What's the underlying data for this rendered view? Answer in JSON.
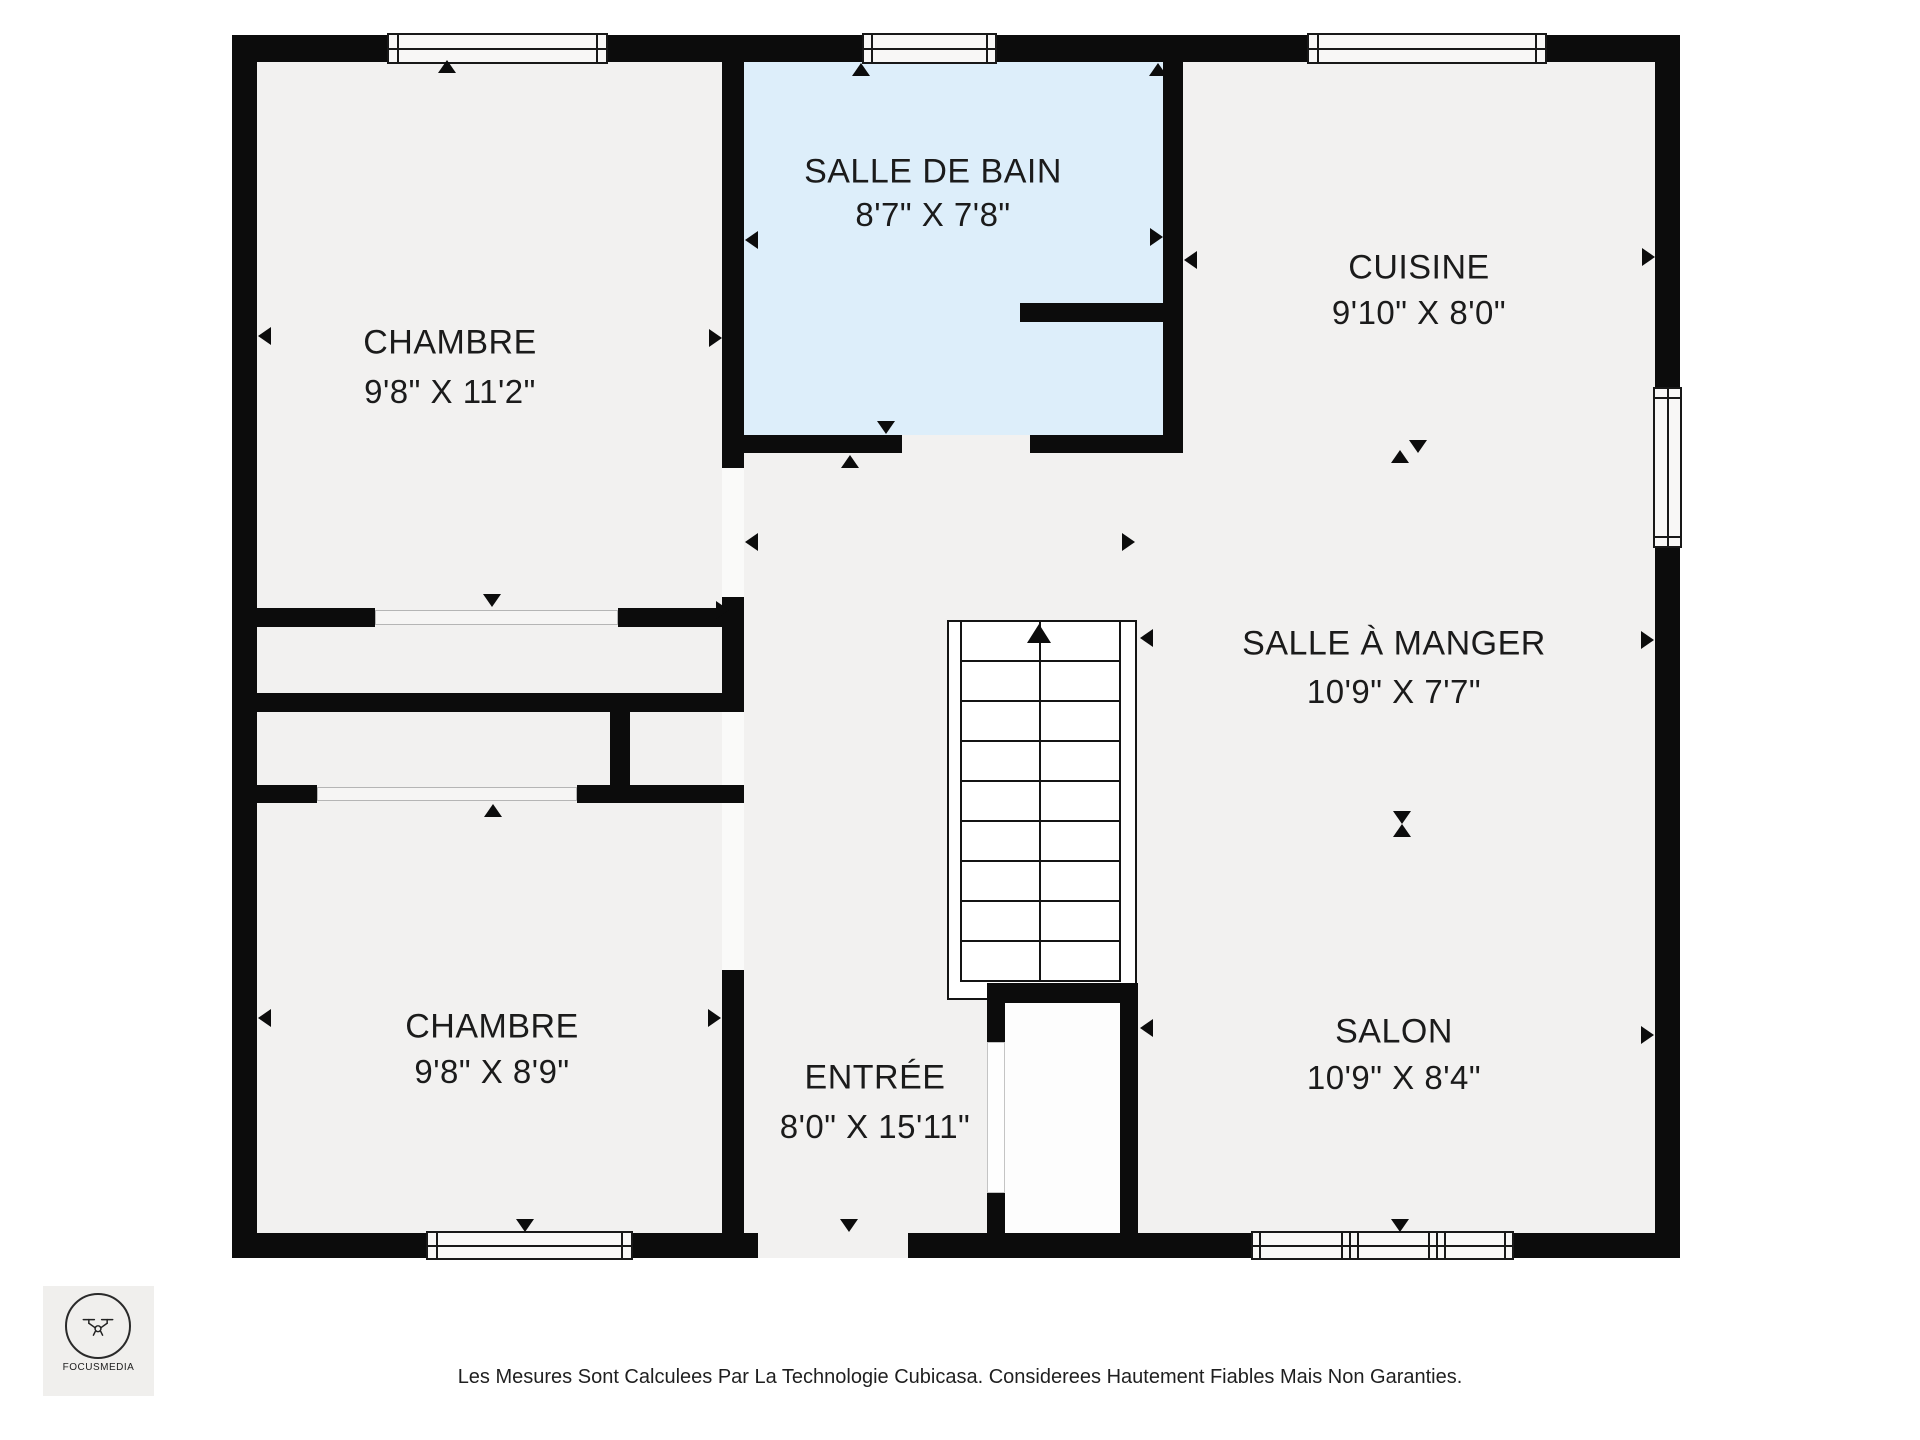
{
  "rooms": [
    {
      "id": "chambre-1",
      "name": "CHAMBRE",
      "dims": "9'8\" X 11'2\""
    },
    {
      "id": "salle-de-bain",
      "name": "SALLE DE BAIN",
      "dims": "8'7\" X 7'8\""
    },
    {
      "id": "cuisine",
      "name": "CUISINE",
      "dims": "9'10\" X 8'0\""
    },
    {
      "id": "salle-a-manger",
      "name": "SALLE À MANGER",
      "dims": "10'9\" X 7'7\""
    },
    {
      "id": "salon",
      "name": "SALON",
      "dims": "10'9\" X 8'4\""
    },
    {
      "id": "entree",
      "name": "ENTRÉE",
      "dims": "8'0\" X 15'11\""
    },
    {
      "id": "chambre-2",
      "name": "CHAMBRE",
      "dims": "9'8\" X 8'9\""
    }
  ],
  "logo": {
    "name": "FOCUSMEDIA"
  },
  "footer": {
    "disclaimer": "Les Mesures Sont Calculees Par La Technologie Cubicasa. Considerees Hautement Fiables Mais Non Garanties."
  },
  "colors": {
    "wall": "#0c0c0c",
    "floor": "#f2f1f0",
    "bathroom_floor": "#ddeefa",
    "background": "#ffffff"
  }
}
